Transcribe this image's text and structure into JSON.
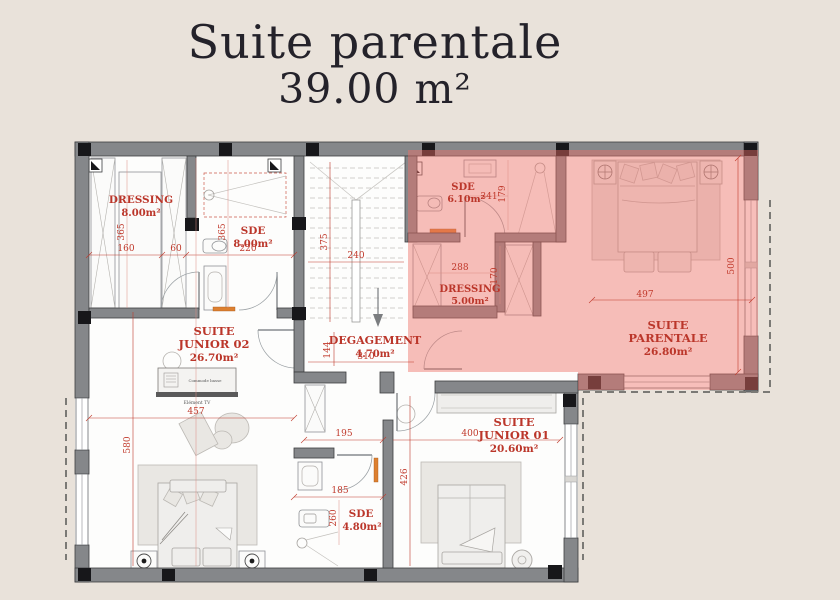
{
  "page": {
    "title": "Suite parentale",
    "subtitle": "39.00 m²"
  },
  "plan": {
    "rooms": {
      "dressing_02": {
        "name": "DRESSING",
        "area": "8.00m²"
      },
      "sde_02": {
        "name": "SDE",
        "area": "8.00m²"
      },
      "suite_junior_02": {
        "name_l1": "SUITE",
        "name_l2": "JUNIOR 02",
        "area": "26.70m²"
      },
      "degagement": {
        "name": "DEGAGEMENT",
        "area": "4.70m²"
      },
      "sde_parentale": {
        "name": "SDE",
        "area": "6.10m²"
      },
      "dressing_parentale": {
        "name": "DRESSING",
        "area": "5.00m²"
      },
      "suite_parentale": {
        "name_l1": "SUITE",
        "name_l2": "PARENTALE",
        "area": "26.80m²"
      },
      "suite_junior_01": {
        "name_l1": "SUITE",
        "name_l2": "JUNIOR 01",
        "area": "20.60m²"
      },
      "sde_01": {
        "name": "SDE",
        "area": "4.80m²"
      }
    },
    "dimensions": {
      "dressing02_h": "365",
      "dressing02_w": "160",
      "sde02_gap": "60",
      "sde02_w": "220",
      "sde02_h": "365",
      "stairs_h": "375",
      "stairs_w": "240",
      "sde_par_w": "341",
      "sde_par_h": "179",
      "dressing_par_w": "288",
      "dressing_par_h": "170",
      "parentale_w": "497",
      "parentale_h": "500",
      "degagement_h": "144",
      "degagement_w": "310",
      "junior02_w": "457",
      "junior02_h": "580",
      "corridor_w": "195",
      "junior01_w": "400",
      "junior01_h": "426",
      "sde01_w": "185",
      "sde01_h": "260"
    },
    "furniture": {
      "commode": "Commode basse",
      "tv": "Elément TV"
    },
    "colors": {
      "background": "#e9e2da",
      "highlight": "#ee6e66",
      "dim_red": "#c0392b",
      "wall_gray": "#85878a"
    }
  }
}
